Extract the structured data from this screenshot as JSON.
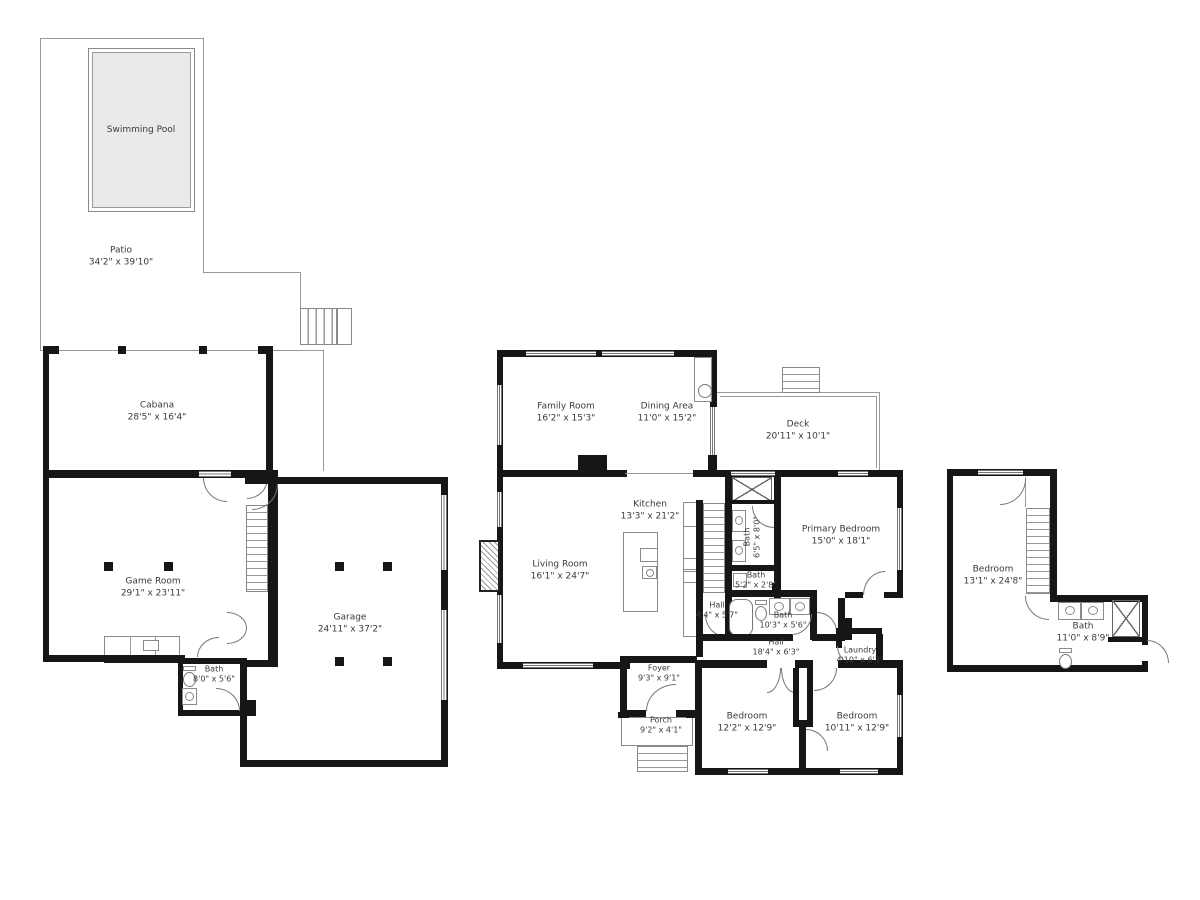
{
  "plan": {
    "type": "residential-floor-plan",
    "colors": {
      "background": "#ffffff",
      "wall": "#161616",
      "outline": "#9a9a9a",
      "pool_fill": "#eaeaea",
      "label_text": "#3a3a3a"
    },
    "rooms": {
      "swimming_pool": {
        "name": "Swimming Pool"
      },
      "patio": {
        "name": "Patio",
        "dims": "34'2\" x 39'10\""
      },
      "cabana": {
        "name": "Cabana",
        "dims": "28'5\" x 16'4\""
      },
      "game_room": {
        "name": "Game Room",
        "dims": "29'1\" x 23'11\""
      },
      "bath_cabana": {
        "name": "Bath",
        "dims": "8'0\" x 5'6\""
      },
      "garage": {
        "name": "Garage",
        "dims": "24'11\" x 37'2\""
      },
      "family_room": {
        "name": "Family Room",
        "dims": "16'2\" x 15'3\""
      },
      "dining_area": {
        "name": "Dining Area",
        "dims": "11'0\" x 15'2\""
      },
      "deck": {
        "name": "Deck",
        "dims": "20'11\" x 10'1\""
      },
      "kitchen": {
        "name": "Kitchen",
        "dims": "13'3\" x 21'2\""
      },
      "living_room": {
        "name": "Living Room",
        "dims": "16'1\" x 24'7\""
      },
      "bath_upper": {
        "name": "Bath",
        "dims": "6'5\" x 8'0\""
      },
      "bath_powder": {
        "name": "Bath",
        "dims": "5'2\" x 2'8\""
      },
      "hall_small": {
        "name": "Hall",
        "dims": "4'4\" x 5'7\""
      },
      "bath_main": {
        "name": "Bath",
        "dims": "10'3\" x 5'6\""
      },
      "hall_main": {
        "name": "Hall",
        "dims": "18'4\" x 6'3\""
      },
      "laundry": {
        "name": "Laundry",
        "dims": "4'10\" x 6'3\""
      },
      "primary_bedroom": {
        "name": "Primary Bedroom",
        "dims": "15'0\" x 18'1\""
      },
      "foyer": {
        "name": "Foyer",
        "dims": "9'3\" x 9'1\""
      },
      "porch": {
        "name": "Porch",
        "dims": "9'2\" x 4'1\""
      },
      "bedroom_1": {
        "name": "Bedroom",
        "dims": "12'2\" x 12'9\""
      },
      "bedroom_2": {
        "name": "Bedroom",
        "dims": "10'11\" x 12'9\""
      },
      "bedroom_right": {
        "name": "Bedroom",
        "dims": "13'1\" x 24'8\""
      },
      "bath_right": {
        "name": "Bath",
        "dims": "11'0\" x 8'9\""
      }
    }
  }
}
